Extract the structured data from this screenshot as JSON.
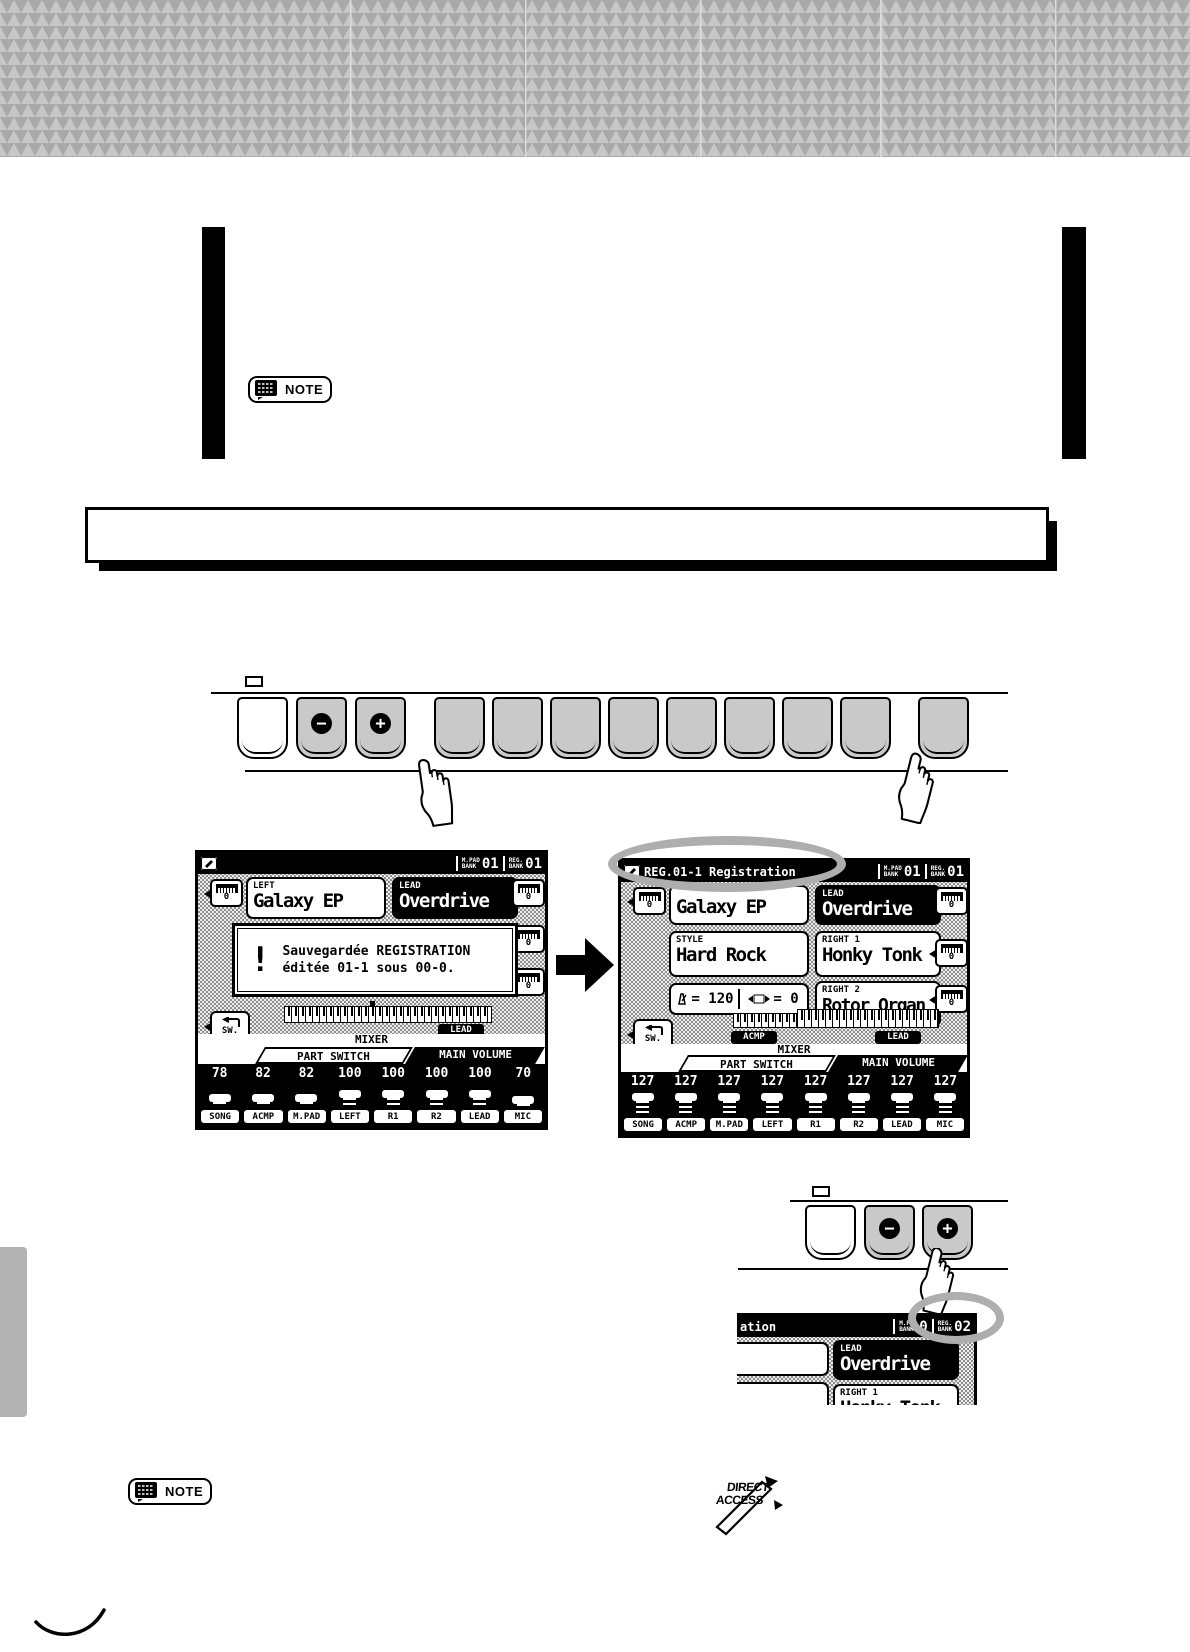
{
  "page": {
    "note_label": "NOTE",
    "direct_access": {
      "line1": "DIRECT",
      "line2": "ACCESS"
    }
  },
  "octave": "0",
  "panel1": {
    "minus": "−",
    "plus": "+"
  },
  "panel2": {
    "minus": "−",
    "plus": "+"
  },
  "screen1": {
    "titlebar": {
      "mpad_l1": "M.PAD",
      "mpad_l2": "BANK",
      "mpad_value": "01",
      "reg_l1": "REG.",
      "reg_l2": "BANK",
      "reg_value": "01"
    },
    "left": {
      "label": "LEFT",
      "value": "Galaxy EP"
    },
    "lead": {
      "label": "LEAD",
      "value": "Overdrive"
    },
    "message": {
      "icon": "!",
      "line1": "Sauvegardée REGISTRATION",
      "line2": "éditée 01-1 sous 00-0."
    },
    "kbd_chip": "LEAD",
    "sw_label": "SW.",
    "mixer": {
      "title": "MIXER",
      "tab_part": "PART SWITCH",
      "tab_volume": "MAIN VOLUME"
    },
    "values": [
      "78",
      "82",
      "82",
      "100",
      "100",
      "100",
      "100",
      "70"
    ],
    "channels": [
      "SONG",
      "ACMP",
      "M.PAD",
      "LEFT",
      "R1",
      "R2",
      "LEAD",
      "MIC"
    ]
  },
  "screen2": {
    "title": "REG.01-1 Registration",
    "titlebar": {
      "mpad_l1": "M.PAD",
      "mpad_l2": "BANK",
      "mpad_value": "01",
      "reg_l1": "REG.",
      "reg_l2": "BANK",
      "reg_value": "01"
    },
    "left": {
      "value": "Galaxy EP"
    },
    "lead": {
      "label": "LEAD",
      "value": "Overdrive"
    },
    "style": {
      "label": "STYLE",
      "value": "Hard Rock"
    },
    "right1": {
      "label": "RIGHT 1",
      "value": "Honky Tonk"
    },
    "right2": {
      "label": "RIGHT 2",
      "value": "Rotor Organ"
    },
    "tempo_display": "= 120",
    "transpose_display": "= 0",
    "acmp_chip": "ACMP",
    "lead_chip": "LEAD",
    "sw_label": "SW.",
    "mixer": {
      "title": "MIXER",
      "tab_part": "PART SWITCH",
      "tab_volume": "MAIN VOLUME"
    },
    "values": [
      "127",
      "127",
      "127",
      "127",
      "127",
      "127",
      "127",
      "127"
    ],
    "channels": [
      "SONG",
      "ACMP",
      "M.PAD",
      "LEFT",
      "R1",
      "R2",
      "LEAD",
      "MIC"
    ]
  },
  "screen3": {
    "title_fragment": "ation",
    "titlebar": {
      "mpad_l1": "M.PAD",
      "mpad_l2": "BANK",
      "mpad_value": "0",
      "reg_l1": "REG.",
      "reg_l2": "BANK",
      "reg_value": "02"
    },
    "lead": {
      "label": "LEAD",
      "value": "Overdrive"
    },
    "right1": {
      "label": "RIGHT 1",
      "value": "Honky Tonk"
    }
  }
}
